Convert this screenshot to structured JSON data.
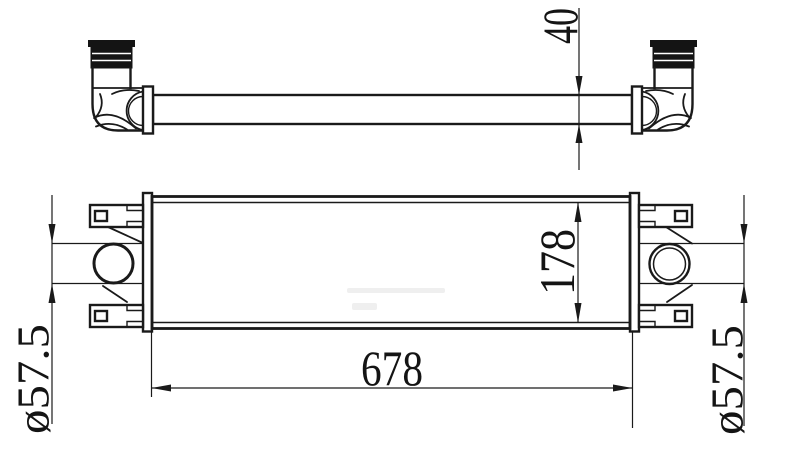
{
  "drawing": {
    "background_color": "#ffffff",
    "line_color": "#1a1a1a",
    "dimensions": {
      "core_thickness": "40",
      "core_height": "178",
      "core_length": "678",
      "left_port_diameter": "ø57.5",
      "right_port_diameter": "ø57.5"
    }
  }
}
